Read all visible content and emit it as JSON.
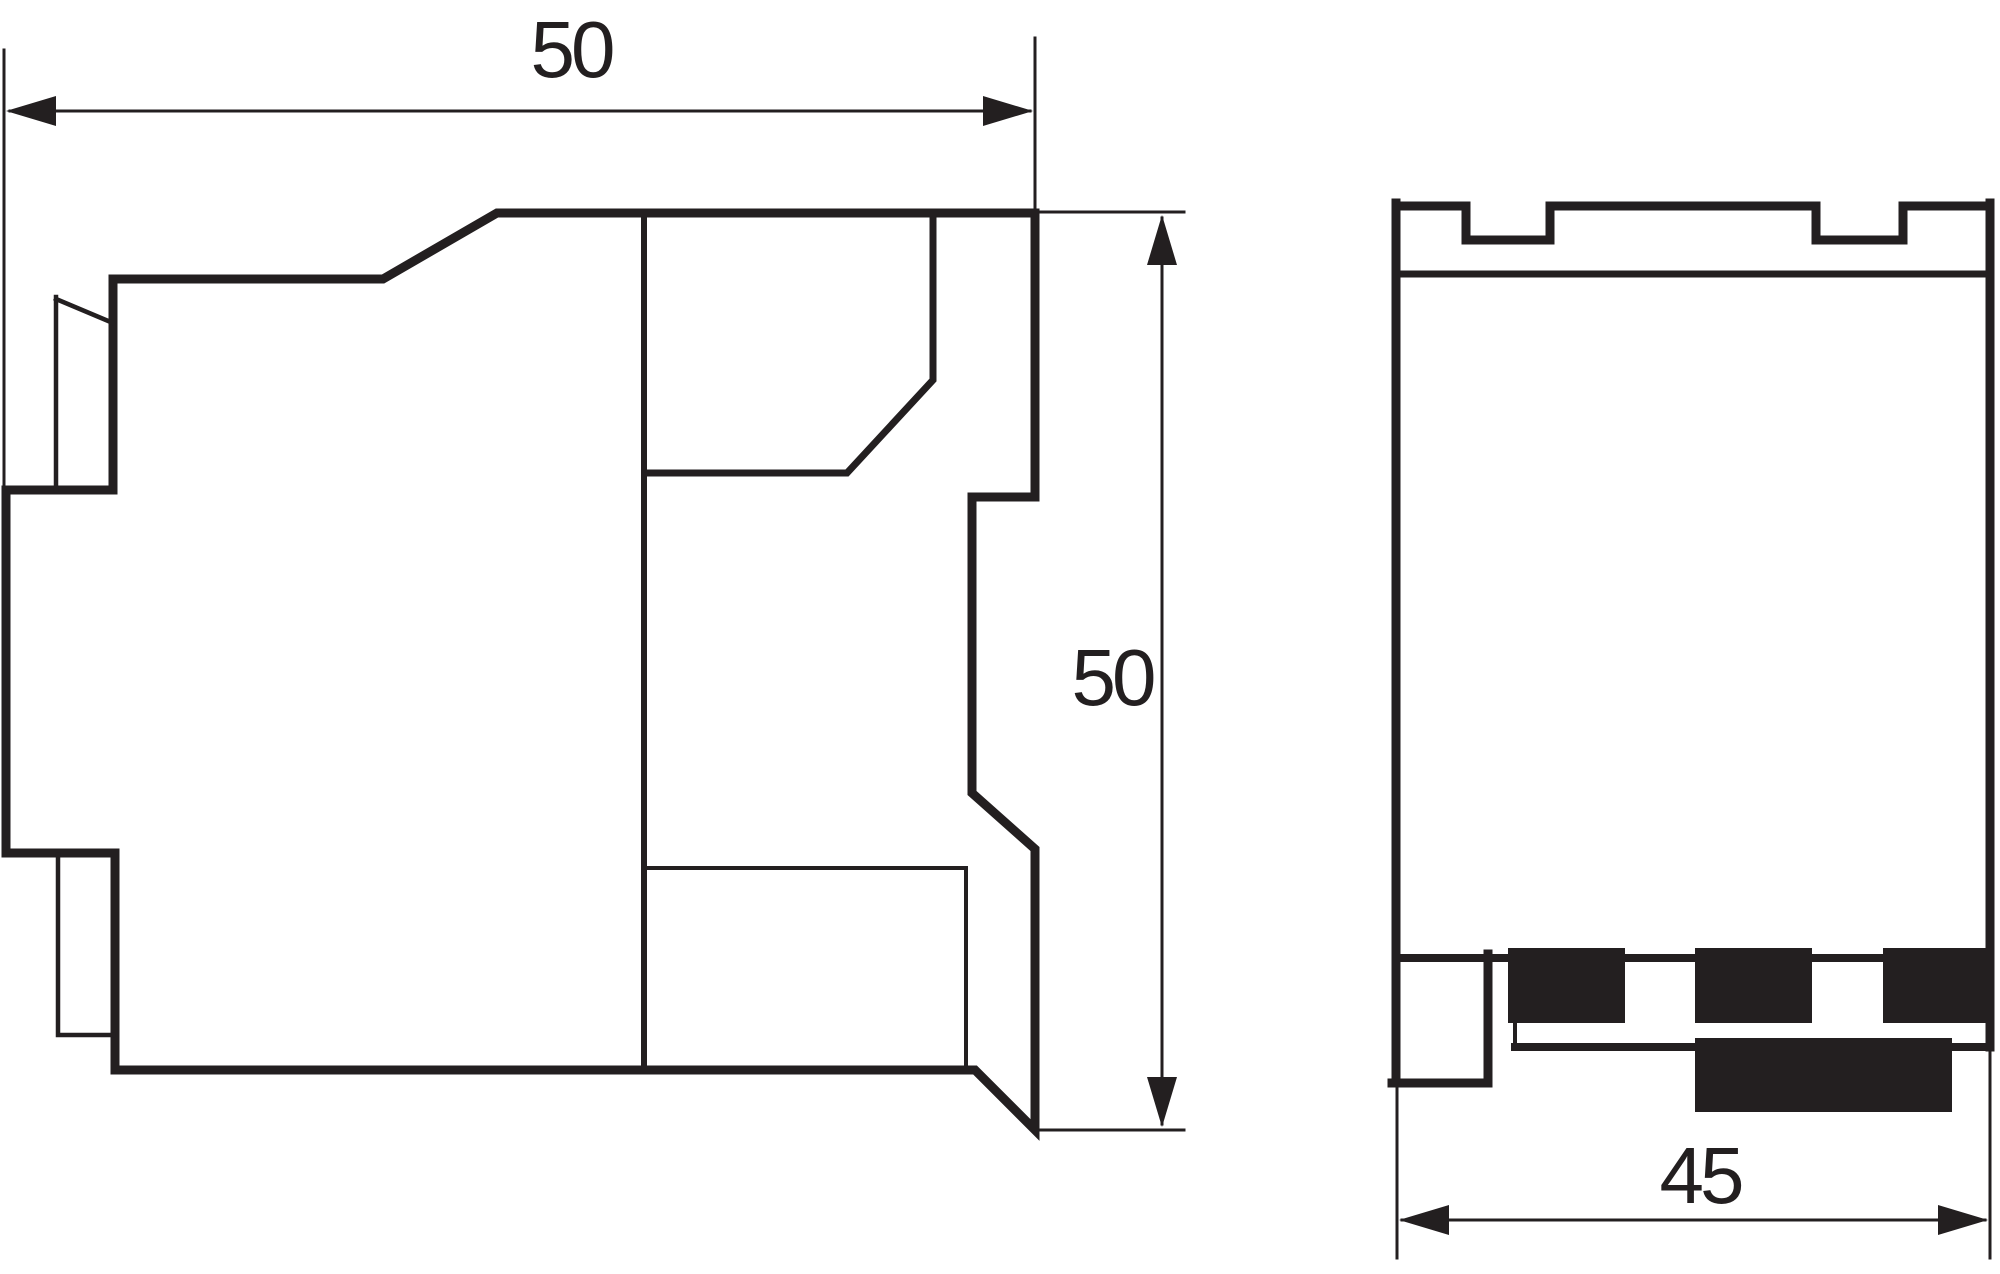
{
  "drawing": {
    "ink_color": "#231f20",
    "background_color": "#ffffff",
    "side_view": {
      "width_dimension": {
        "value": "50"
      },
      "height_dimension": {
        "value": "50"
      }
    },
    "front_view": {
      "width_dimension": {
        "value": "45"
      }
    }
  }
}
